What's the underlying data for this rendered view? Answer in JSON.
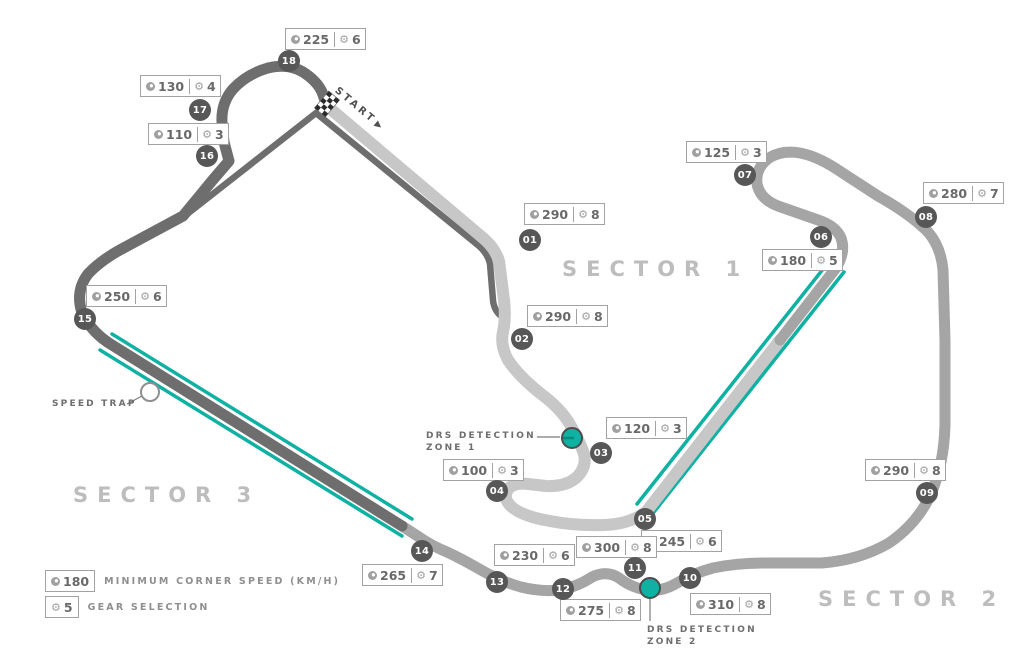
{
  "colors": {
    "teal": "#0fb1a2",
    "sector1_track": "#c7c7c7",
    "sector2_track": "#a5a5a5",
    "sector3_track": "#6e6e6e",
    "badge_bg": "#575757",
    "box_border": "#a2a2a2"
  },
  "icons": {
    "gear_glyph": "⚙"
  },
  "start": {
    "label": "START",
    "arrow": "▶"
  },
  "speed_trap": {
    "label": "SPEED TRAP"
  },
  "sectors": [
    {
      "label": "SECTOR 1"
    },
    {
      "label": "SECTOR 2"
    },
    {
      "label": "SECTOR 3"
    }
  ],
  "drs_zones": [
    {
      "line1": "DRS DETECTION",
      "line2": "ZONE 1"
    },
    {
      "line1": "DRS DETECTION",
      "line2": "ZONE 2"
    }
  ],
  "legend": {
    "speed_value": "180",
    "speed_text": "MINIMUM CORNER SPEED (KM/H)",
    "gear_value": "5",
    "gear_text": "GEAR SELECTION"
  },
  "corners": [
    {
      "num": "01",
      "speed": "290",
      "gear": "8",
      "badge": {
        "x": 530,
        "y": 240
      },
      "label": {
        "x": 524,
        "y": 203
      }
    },
    {
      "num": "02",
      "speed": "290",
      "gear": "8",
      "badge": {
        "x": 522,
        "y": 339
      },
      "label": {
        "x": 527,
        "y": 305
      }
    },
    {
      "num": "03",
      "speed": "120",
      "gear": "3",
      "badge": {
        "x": 601,
        "y": 453
      },
      "label": {
        "x": 606,
        "y": 417
      }
    },
    {
      "num": "04",
      "speed": "100",
      "gear": "3",
      "badge": {
        "x": 497,
        "y": 491
      },
      "label": {
        "x": 443,
        "y": 459
      }
    },
    {
      "num": "05",
      "speed": "245",
      "gear": "6",
      "badge": {
        "x": 645,
        "y": 519
      },
      "label": {
        "x": 641,
        "y": 530
      }
    },
    {
      "num": "06",
      "speed": "180",
      "gear": "5",
      "badge": {
        "x": 821,
        "y": 237
      },
      "label": {
        "x": 762,
        "y": 249
      }
    },
    {
      "num": "07",
      "speed": "125",
      "gear": "3",
      "badge": {
        "x": 745,
        "y": 175
      },
      "label": {
        "x": 686,
        "y": 141
      }
    },
    {
      "num": "08",
      "speed": "280",
      "gear": "7",
      "badge": {
        "x": 926,
        "y": 217
      },
      "label": {
        "x": 923,
        "y": 182
      }
    },
    {
      "num": "09",
      "speed": "290",
      "gear": "8",
      "badge": {
        "x": 927,
        "y": 493
      },
      "label": {
        "x": 865,
        "y": 459
      }
    },
    {
      "num": "10",
      "speed": "310",
      "gear": "8",
      "badge": {
        "x": 690,
        "y": 578
      },
      "label": {
        "x": 690,
        "y": 593
      }
    },
    {
      "num": "11",
      "speed": "300",
      "gear": "8",
      "badge": {
        "x": 635,
        "y": 568
      },
      "label": {
        "x": 576,
        "y": 536
      }
    },
    {
      "num": "12",
      "speed": "275",
      "gear": "8",
      "badge": {
        "x": 563,
        "y": 589
      },
      "label": {
        "x": 560,
        "y": 599
      }
    },
    {
      "num": "13",
      "speed": "230",
      "gear": "6",
      "badge": {
        "x": 497,
        "y": 582
      },
      "label": {
        "x": 494,
        "y": 544
      }
    },
    {
      "num": "14",
      "speed": "265",
      "gear": "7",
      "badge": {
        "x": 422,
        "y": 551
      },
      "label": {
        "x": 362,
        "y": 564
      }
    },
    {
      "num": "15",
      "speed": "250",
      "gear": "6",
      "badge": {
        "x": 85,
        "y": 319
      },
      "label": {
        "x": 86,
        "y": 285
      }
    },
    {
      "num": "16",
      "speed": "110",
      "gear": "3",
      "badge": {
        "x": 207,
        "y": 156
      },
      "label": {
        "x": 148,
        "y": 123
      }
    },
    {
      "num": "17",
      "speed": "130",
      "gear": "4",
      "badge": {
        "x": 200,
        "y": 110
      },
      "label": {
        "x": 140,
        "y": 75
      }
    },
    {
      "num": "18",
      "speed": "225",
      "gear": "6",
      "badge": {
        "x": 289,
        "y": 61
      },
      "label": {
        "x": 285,
        "y": 28
      }
    }
  ]
}
